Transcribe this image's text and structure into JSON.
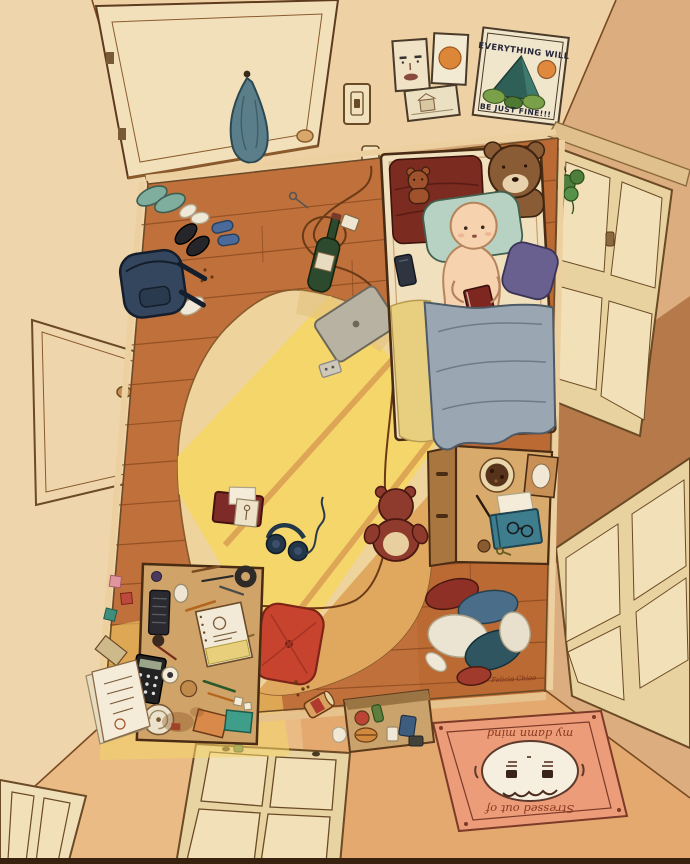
{
  "artwork": {
    "poster": {
      "line1": "EVERYTHING WILL",
      "line2": "BE JUST FINE!!!"
    },
    "door_mat": {
      "line1": "Stressed out of",
      "line2": "my damn mind"
    },
    "signature": "Felicia Chiao"
  },
  "palette": {
    "wall_top": "#eed2a6",
    "wall_left": "#efd5ac",
    "wall_right": "#dcad7f",
    "wall_right_dark": "#b5794a",
    "wall_bottom": "#e3a96f",
    "floor_wood": "#c0703a",
    "floor_line": "#8a4a20",
    "rug_cream": "#eed49c",
    "rug_shade": "#e0a85e",
    "sunlight": "#f4d66a",
    "bed_sheet": "#f0e0bd",
    "blanket_maroon": "#7c2b20",
    "pillow_teal": "#b7d2c2",
    "pillow_purple": "#696090",
    "blanket_gray": "#9aa6b2",
    "blanket_trim": "#e7cf7f",
    "skin": "#f6d2ae",
    "teddy_brown": "#8a5c36",
    "teddy_small": "#a0522d",
    "teddy_floor_red": "#8e3a2c",
    "mat_salmon": "#ec9c79",
    "cushion_red": "#c8432e",
    "backpack_navy": "#33465e",
    "desk_wood": "#d0a469",
    "towel_blue": "#5b7f8a",
    "window_frame": "#e8d2a0",
    "window_pane": "#f2e0b8",
    "outline": "#5e3a1e"
  }
}
